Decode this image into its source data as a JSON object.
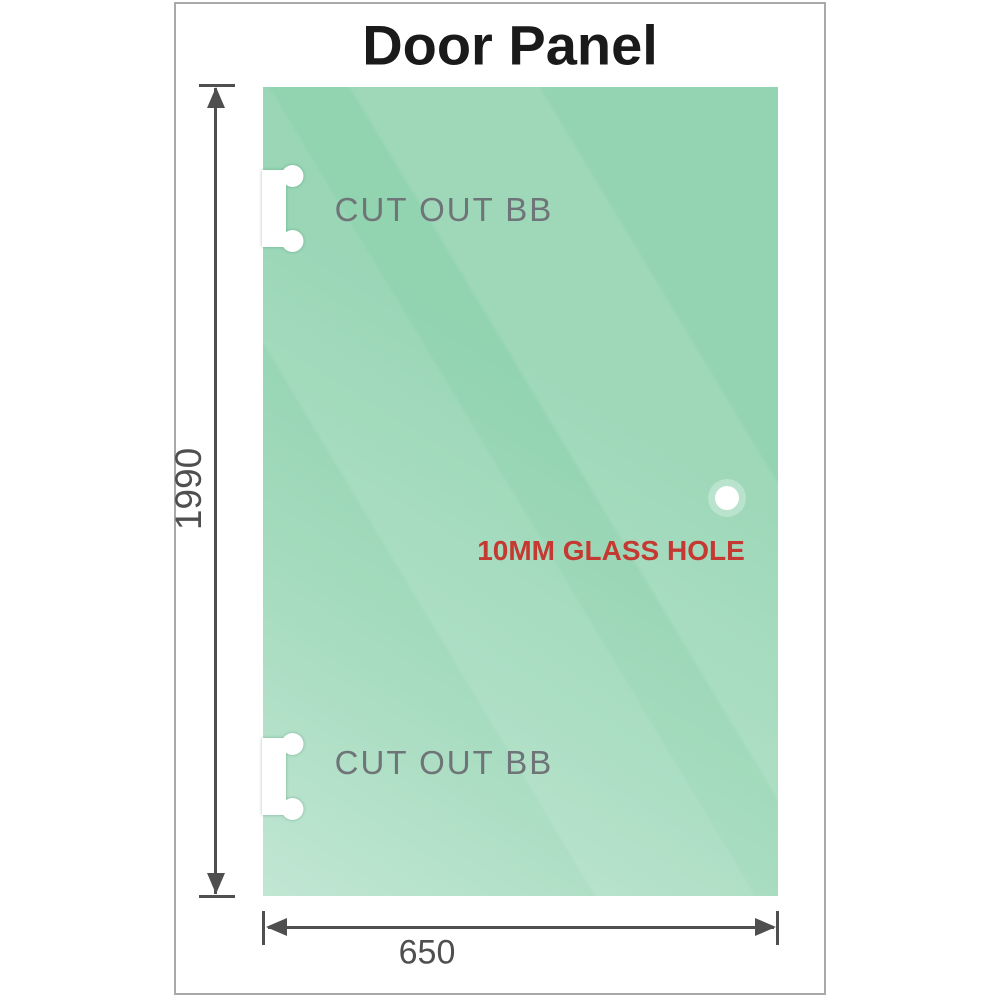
{
  "title": "Door Panel",
  "panel": {
    "cutout_top_label": "CUT OUT BB",
    "cutout_bottom_label": "CUT OUT BB",
    "glass_hole_label": "10MM GLASS HOLE"
  },
  "dimensions": {
    "height_value": "1990",
    "width_value": "650"
  },
  "colors": {
    "glass_base": "#8ed2ae",
    "glass_highlight": "#c9ecd8",
    "dimension_lines": "#4f4f4f",
    "cutout_label_text": "#6f7478",
    "glass_hole_label_text": "#c43a32",
    "title_text": "#1a1a1a",
    "frame_border": "#a9a9a9"
  }
}
